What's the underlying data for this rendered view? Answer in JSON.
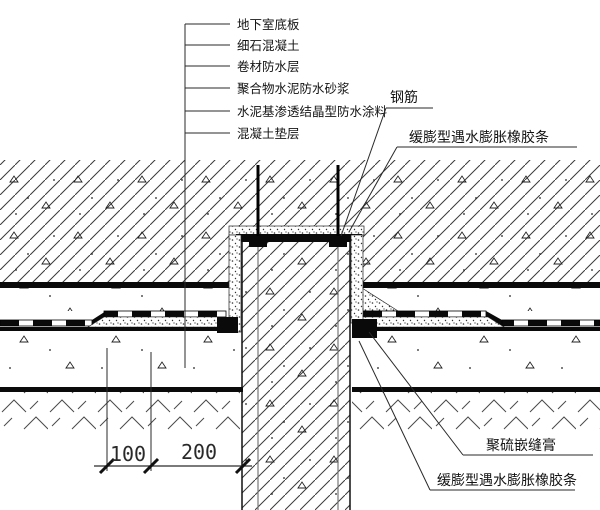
{
  "drawing": {
    "kind": "pile-head-basement-slab-waterproofing-detail"
  },
  "layers": [
    "地下室底板",
    "细石混凝土",
    "卷材防水层",
    "聚合物水泥防水砂浆",
    "水泥基渗透结晶型防水涂料",
    "混凝土垫层"
  ],
  "callouts": {
    "rebar": "钢筋",
    "top_strip": "缓膨型遇水膨胀橡胶条",
    "sealant": "聚硫嵌缝膏",
    "bottom_strip": "缓膨型遇水膨胀橡胶条"
  },
  "dims": {
    "left": "100",
    "right": "200"
  },
  "colors": {
    "ink": "#141414",
    "background": "#ffffff"
  }
}
